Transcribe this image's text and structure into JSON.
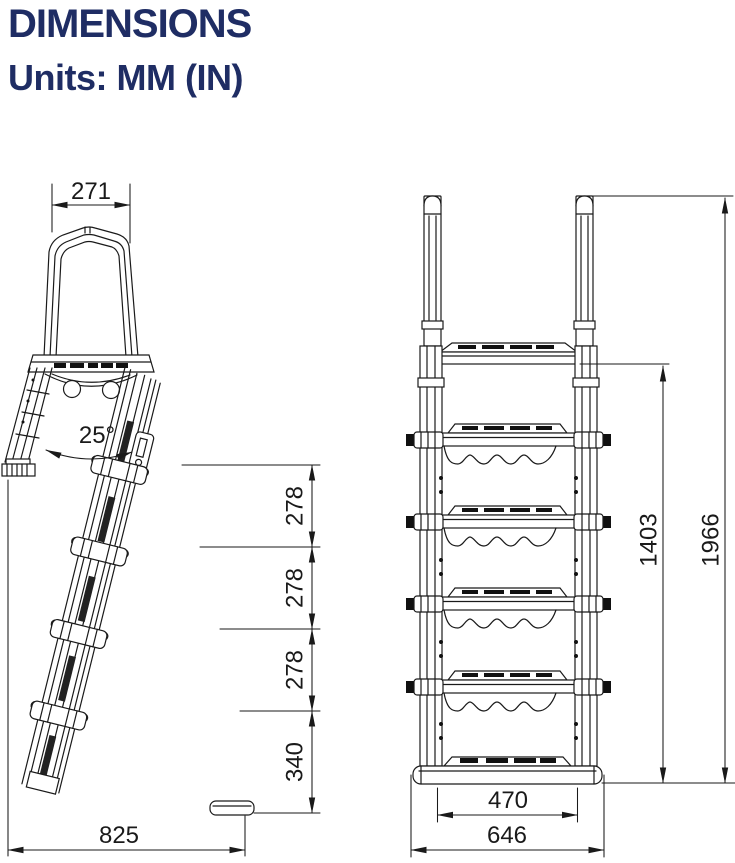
{
  "page": {
    "title": "DIMENSIONS",
    "subtitle": "Units: MM (IN)"
  },
  "colors": {
    "heading_text": "#1f2d64",
    "drawing_line": "#1a1a1a",
    "background": "#ffffff"
  },
  "views": {
    "side": {
      "name": "ladder side view",
      "dims": {
        "handle_width_mm": "271",
        "leg_angle": "25°",
        "step_gap_1_mm": "278",
        "step_gap_2_mm": "278",
        "step_gap_3_mm": "278",
        "bottom_gap_mm": "340",
        "footprint_depth_mm": "825"
      }
    },
    "front": {
      "name": "ladder front view",
      "dims": {
        "tread_width_mm": "470",
        "base_width_mm": "646",
        "deck_height_mm": "1403",
        "overall_height_mm": "1966"
      }
    }
  }
}
